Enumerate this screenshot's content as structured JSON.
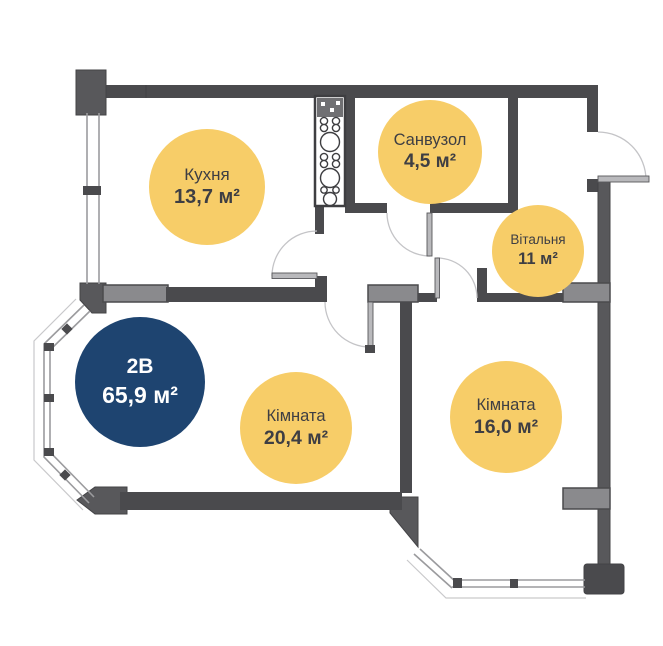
{
  "plan": {
    "title": "apartment-floor-plan",
    "unit_badge": {
      "code": "2В",
      "area": "65,9 м²"
    },
    "rooms": {
      "kitchen": {
        "name": "Кухня",
        "area": "13,7 м²"
      },
      "bathroom": {
        "name": "Санвузол",
        "area": "4,5 м²"
      },
      "living": {
        "name": "Вітальня",
        "area": "11 м²"
      },
      "bedroom1": {
        "name": "Кімната",
        "area": "20,4 м²"
      },
      "bedroom2": {
        "name": "Кімната",
        "area": "16,0 м²"
      }
    },
    "colors": {
      "label_yellow": "#F7CD68",
      "badge_navy": "#1E4470",
      "wall_dark": "#4A4A4D",
      "wall_light": "#8A8A8D",
      "window_line": "#9B9B9E",
      "text_dark": "#3E3E43"
    }
  }
}
